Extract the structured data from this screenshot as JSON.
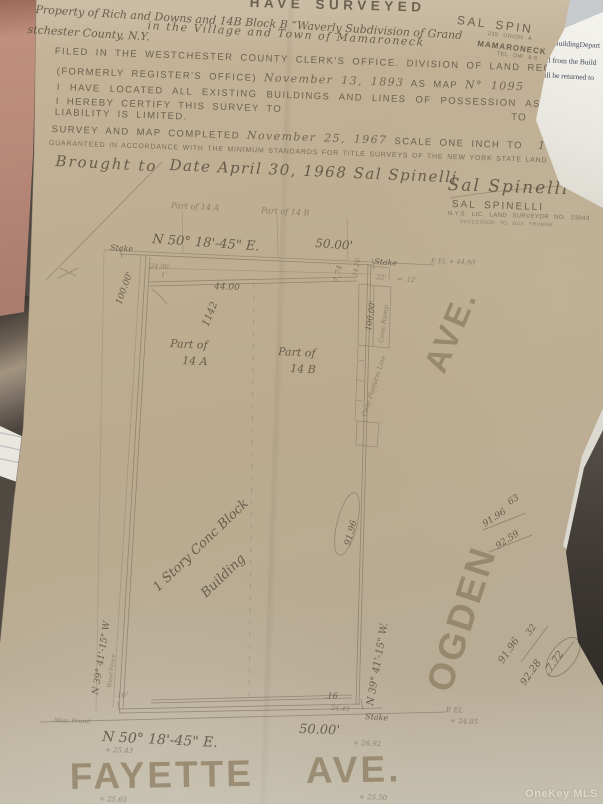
{
  "watermark": "OneKey MLS",
  "note": {
    "line1": "to BuildingDepart",
    "line2": "call from the Build",
    "line3": "—ill be returned to"
  },
  "surveyor_card": {
    "name": "SAL SPIN",
    "street": "235 UNION A",
    "city": "MAMARONECK",
    "phone": "TEL OW 8-5"
  },
  "header": {
    "have_surveyed": "HAVE SURVEYED",
    "hw_top1": "Property of Rich and Downs and 14B Block B  “Waverly Subdivision of Grand",
    "hw_top2a": "stchester County, N.Y.",
    "hw_top2b": "in the Village and Town of Mamaroneck",
    "filed": "FILED IN THE WESTCHESTER COUNTY CLERK'S OFFICE. DIVISION OF LAND RECORDS",
    "formerly": "(FORMERLY REGISTER'S OFFICE)",
    "formerly_date": "November 13, 1893",
    "as_map": "AS MAP",
    "map_no": "N° 1095",
    "located": "I HAVE LOCATED ALL EXISTING BUILDINGS AND LINES OF POSSESSION AS SHOWN",
    "certify": "I HEREBY CERTIFY THIS SURVEY TO",
    "liability": "LIABILITY IS LIMITED.",
    "completed": "SURVEY AND MAP COMPLETED",
    "completed_date": "November 25, 1967",
    "scale": "SCALE ONE INCH TO",
    "scale_val": "16",
    "feet": "FEET.",
    "guaranteed": "GUARANTEED IN ACCORDANCE WITH THE MINIMUM STANDARDS FOR TITLE SURVEYS OF THE NEW YORK STATE LAND TITLE ASSOC",
    "brought1": "Brought to",
    "brought2": "Date  April 30, 1968  Sal Spinelli",
    "signature": "Sal Spinelli",
    "surveyor_name": "SAL SPINELLI",
    "surveyor_license": "N.Y.S. LIC. LAND SURVEYOR NO. 23043",
    "surveyor_successor": "SUCCESSOR TO GUS FRUMAN"
  },
  "drawing": {
    "labels": [
      {
        "t": "Part of 14 A",
        "x": 171,
        "y": 208,
        "r": 3,
        "s": 8,
        "c": "hw f"
      },
      {
        "t": "Part of 14 B",
        "x": 261,
        "y": 213,
        "r": 3,
        "s": 8,
        "c": "hw f"
      },
      {
        "t": "N 50° 18'-45\" E.",
        "x": 152,
        "y": 243,
        "r": 4,
        "s": 13,
        "c": "hw"
      },
      {
        "t": "50.00'",
        "x": 315,
        "y": 247,
        "r": 4,
        "s": 12,
        "c": "hw"
      },
      {
        "t": "Stake",
        "x": 110,
        "y": 250,
        "r": 4,
        "s": 8,
        "c": "hw"
      },
      {
        "t": "Stake",
        "x": 374,
        "y": 264,
        "r": 4,
        "s": 8,
        "c": "hw"
      },
      {
        "t": "24.00",
        "x": 150,
        "y": 268,
        "r": 3,
        "s": 6.5,
        "c": "hw f"
      },
      {
        "t": "1'",
        "x": 161,
        "y": 277,
        "r": 3,
        "s": 6.5,
        "c": "hw f"
      },
      {
        "t": "44.00",
        "x": 214,
        "y": 289,
        "r": 2,
        "s": 9,
        "c": "hw"
      },
      {
        "t": "7.74",
        "x": 339,
        "y": 283,
        "r": -80,
        "s": 8,
        "c": "hw f"
      },
      {
        "t": "24.20",
        "x": 357,
        "y": 277,
        "r": -80,
        "s": 6.5,
        "c": "hw f"
      },
      {
        "t": ".22'",
        "x": 374,
        "y": 279,
        "r": 3,
        "s": 6.5,
        "c": "hw f"
      },
      {
        "t": "= .12'",
        "x": 397,
        "y": 281,
        "r": 3,
        "s": 6.5,
        "c": "hw f"
      },
      {
        "t": "E EL + 44.40",
        "x": 431,
        "y": 263,
        "r": 2,
        "s": 6.5,
        "c": "hw f"
      },
      {
        "t": "100.00'",
        "x": 121,
        "y": 305,
        "r": -70,
        "s": 9,
        "c": "hw"
      },
      {
        "t": "1142",
        "x": 208,
        "y": 327,
        "r": -68,
        "s": 10,
        "c": "hw"
      },
      {
        "t": "100.00'",
        "x": 371,
        "y": 331,
        "r": -82,
        "s": 8,
        "c": "hw"
      },
      {
        "t": "Conc Ramp",
        "x": 383,
        "y": 343,
        "r": -82,
        "s": 6.5,
        "c": "hw f"
      },
      {
        "t": "Conc Platform Line",
        "x": 366,
        "y": 417,
        "r": -72,
        "s": 6.5,
        "c": "hw f"
      },
      {
        "t": "Part of",
        "x": 170,
        "y": 347,
        "r": 3,
        "s": 11,
        "c": "hw"
      },
      {
        "t": "14 A",
        "x": 182,
        "y": 364,
        "r": 3,
        "s": 11,
        "c": "hw"
      },
      {
        "t": "Part of",
        "x": 278,
        "y": 355,
        "r": 3,
        "s": 11,
        "c": "hw"
      },
      {
        "t": "14 B",
        "x": 290,
        "y": 372,
        "r": 3,
        "s": 11,
        "c": "hw"
      },
      {
        "t": "1 Story Conc Block",
        "x": 158,
        "y": 592,
        "r": -44,
        "s": 13,
        "c": "hw"
      },
      {
        "t": "Building",
        "x": 206,
        "y": 598,
        "r": -44,
        "s": 13,
        "c": "hw"
      },
      {
        "t": "91.96",
        "x": 350,
        "y": 546,
        "r": -75,
        "s": 9,
        "c": "hw"
      },
      {
        "t": "N 39° 41'-15\" W.",
        "x": 373,
        "y": 706,
        "r": -80,
        "s": 10,
        "c": "hw"
      },
      {
        "t": "N 39° 41'-15\" W",
        "x": 98,
        "y": 695,
        "r": -81,
        "s": 9,
        "c": "hw"
      },
      {
        "t": "Wood Fence",
        "x": 111,
        "y": 688,
        "r": -83,
        "s": 5.5,
        "c": "hw f"
      },
      {
        "t": ".16'",
        "x": 115,
        "y": 697,
        "r": 2,
        "s": 7,
        "c": "hw f"
      },
      {
        "t": ".16",
        "x": 325,
        "y": 698,
        "r": 2,
        "s": 8,
        "c": "hw"
      },
      {
        "t": "24.45",
        "x": 331,
        "y": 710,
        "r": 3,
        "s": 6.5,
        "c": "hw f"
      },
      {
        "t": "Stake",
        "x": 365,
        "y": 719,
        "r": 4,
        "s": 8,
        "c": "hw"
      },
      {
        "t": "Mon. Found",
        "x": 54,
        "y": 722,
        "r": 2,
        "s": 6,
        "c": "hw f"
      },
      {
        "t": "N 50° 18'-45\" E.",
        "x": 102,
        "y": 741,
        "r": 3,
        "s": 14,
        "c": "hw"
      },
      {
        "t": "50.00'",
        "x": 299,
        "y": 733,
        "r": 2,
        "s": 13,
        "c": "hw"
      },
      {
        "t": "+ 25.43",
        "x": 105,
        "y": 752,
        "r": 2,
        "s": 7,
        "c": "hw f"
      },
      {
        "t": "+ 26.92",
        "x": 353,
        "y": 745,
        "r": 2,
        "s": 7,
        "c": "hw f"
      },
      {
        "t": "E EL",
        "x": 446,
        "y": 712,
        "r": 2,
        "s": 7,
        "c": "hw f"
      },
      {
        "t": "+ 24.85",
        "x": 450,
        "y": 723,
        "r": 2,
        "s": 7,
        "c": "hw f"
      },
      {
        "t": "+ 25.65",
        "x": 99,
        "y": 801,
        "r": 2,
        "s": 7,
        "c": "hw f"
      },
      {
        "t": "+ 25.50",
        "x": 359,
        "y": 799,
        "r": 2,
        "s": 7,
        "c": "hw f"
      },
      {
        "t": "FAYETTE",
        "x": 70,
        "y": 789,
        "r": -1,
        "s": 37,
        "c": "street"
      },
      {
        "t": "AVE.",
        "x": 306,
        "y": 783,
        "r": -1,
        "s": 37,
        "c": "street"
      },
      {
        "t": "OGDEN",
        "x": 450,
        "y": 694,
        "r": -72,
        "s": 37,
        "c": "street"
      },
      {
        "t": "AVE.",
        "x": 444,
        "y": 375,
        "r": -67,
        "s": 33,
        "c": "street"
      },
      {
        "t": "63",
        "x": 510,
        "y": 505,
        "r": -33,
        "s": 9,
        "c": "hw"
      },
      {
        "t": "91.96",
        "x": 485,
        "y": 527,
        "r": -33,
        "s": 9,
        "c": "hw"
      },
      {
        "t": "92.59",
        "x": 498,
        "y": 549,
        "r": -33,
        "s": 9,
        "c": "hw"
      },
      {
        "t": "91.96",
        "x": 503,
        "y": 664,
        "r": -55,
        "s": 10,
        "c": "hw"
      },
      {
        "t": "32",
        "x": 530,
        "y": 636,
        "r": -55,
        "s": 9,
        "c": "hw"
      },
      {
        "t": "92.28",
        "x": 525,
        "y": 686,
        "r": -55,
        "s": 10,
        "c": "hw"
      },
      {
        "t": "7.72",
        "x": 551,
        "y": 672,
        "r": -55,
        "s": 10,
        "c": "hw"
      },
      {
        "t": "TO",
        "x": 511,
        "y": 120,
        "r": 2,
        "s": 10,
        "c": "typ"
      }
    ]
  }
}
